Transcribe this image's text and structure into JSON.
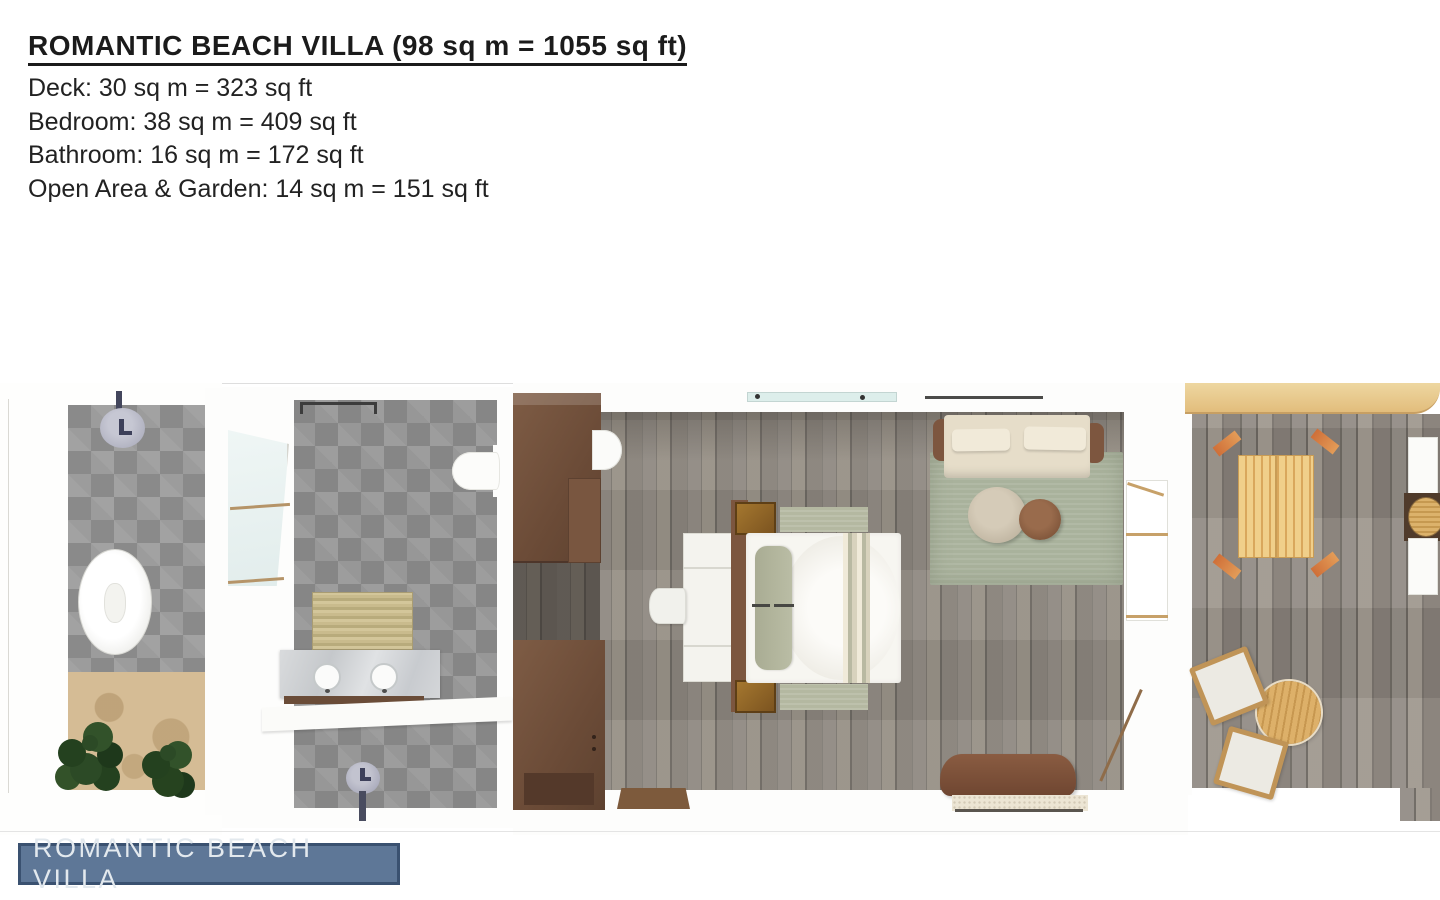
{
  "header": {
    "title": "ROMANTIC BEACH VILLA (98 sq m = 1055 sq ft)",
    "specs": [
      "Deck: 30 sq m = 323 sq ft",
      "Bedroom: 38 sq m = 409 sq ft",
      "Bathroom: 16 sq m = 172 sq ft",
      "Open Area & Garden: 14 sq m = 151 sq ft"
    ]
  },
  "badge": {
    "label": "ROMANTIC BEACH VILLA"
  },
  "palette": {
    "text": "#1b1b1b",
    "badge_bg": "#5e7797",
    "badge_border": "#3a5170",
    "badge_text": "#e3e9ee",
    "tile_gray": "#9c9c9c",
    "wood_floor_gray": "#8a847c",
    "deck_beam_tan": "#e2bd7c",
    "wardrobe_brown": "#6b4b37",
    "rug_green": "#a9b29c",
    "sofa_beige": "#e6ddc9",
    "bed_white": "#f7f6f1",
    "daybed_tan": "#e9c87e",
    "accent_orange": "#cf6f38",
    "sand": "#d5bc95",
    "plant_green": "#2c4a26",
    "glass_blue": "#ddeeeb"
  }
}
